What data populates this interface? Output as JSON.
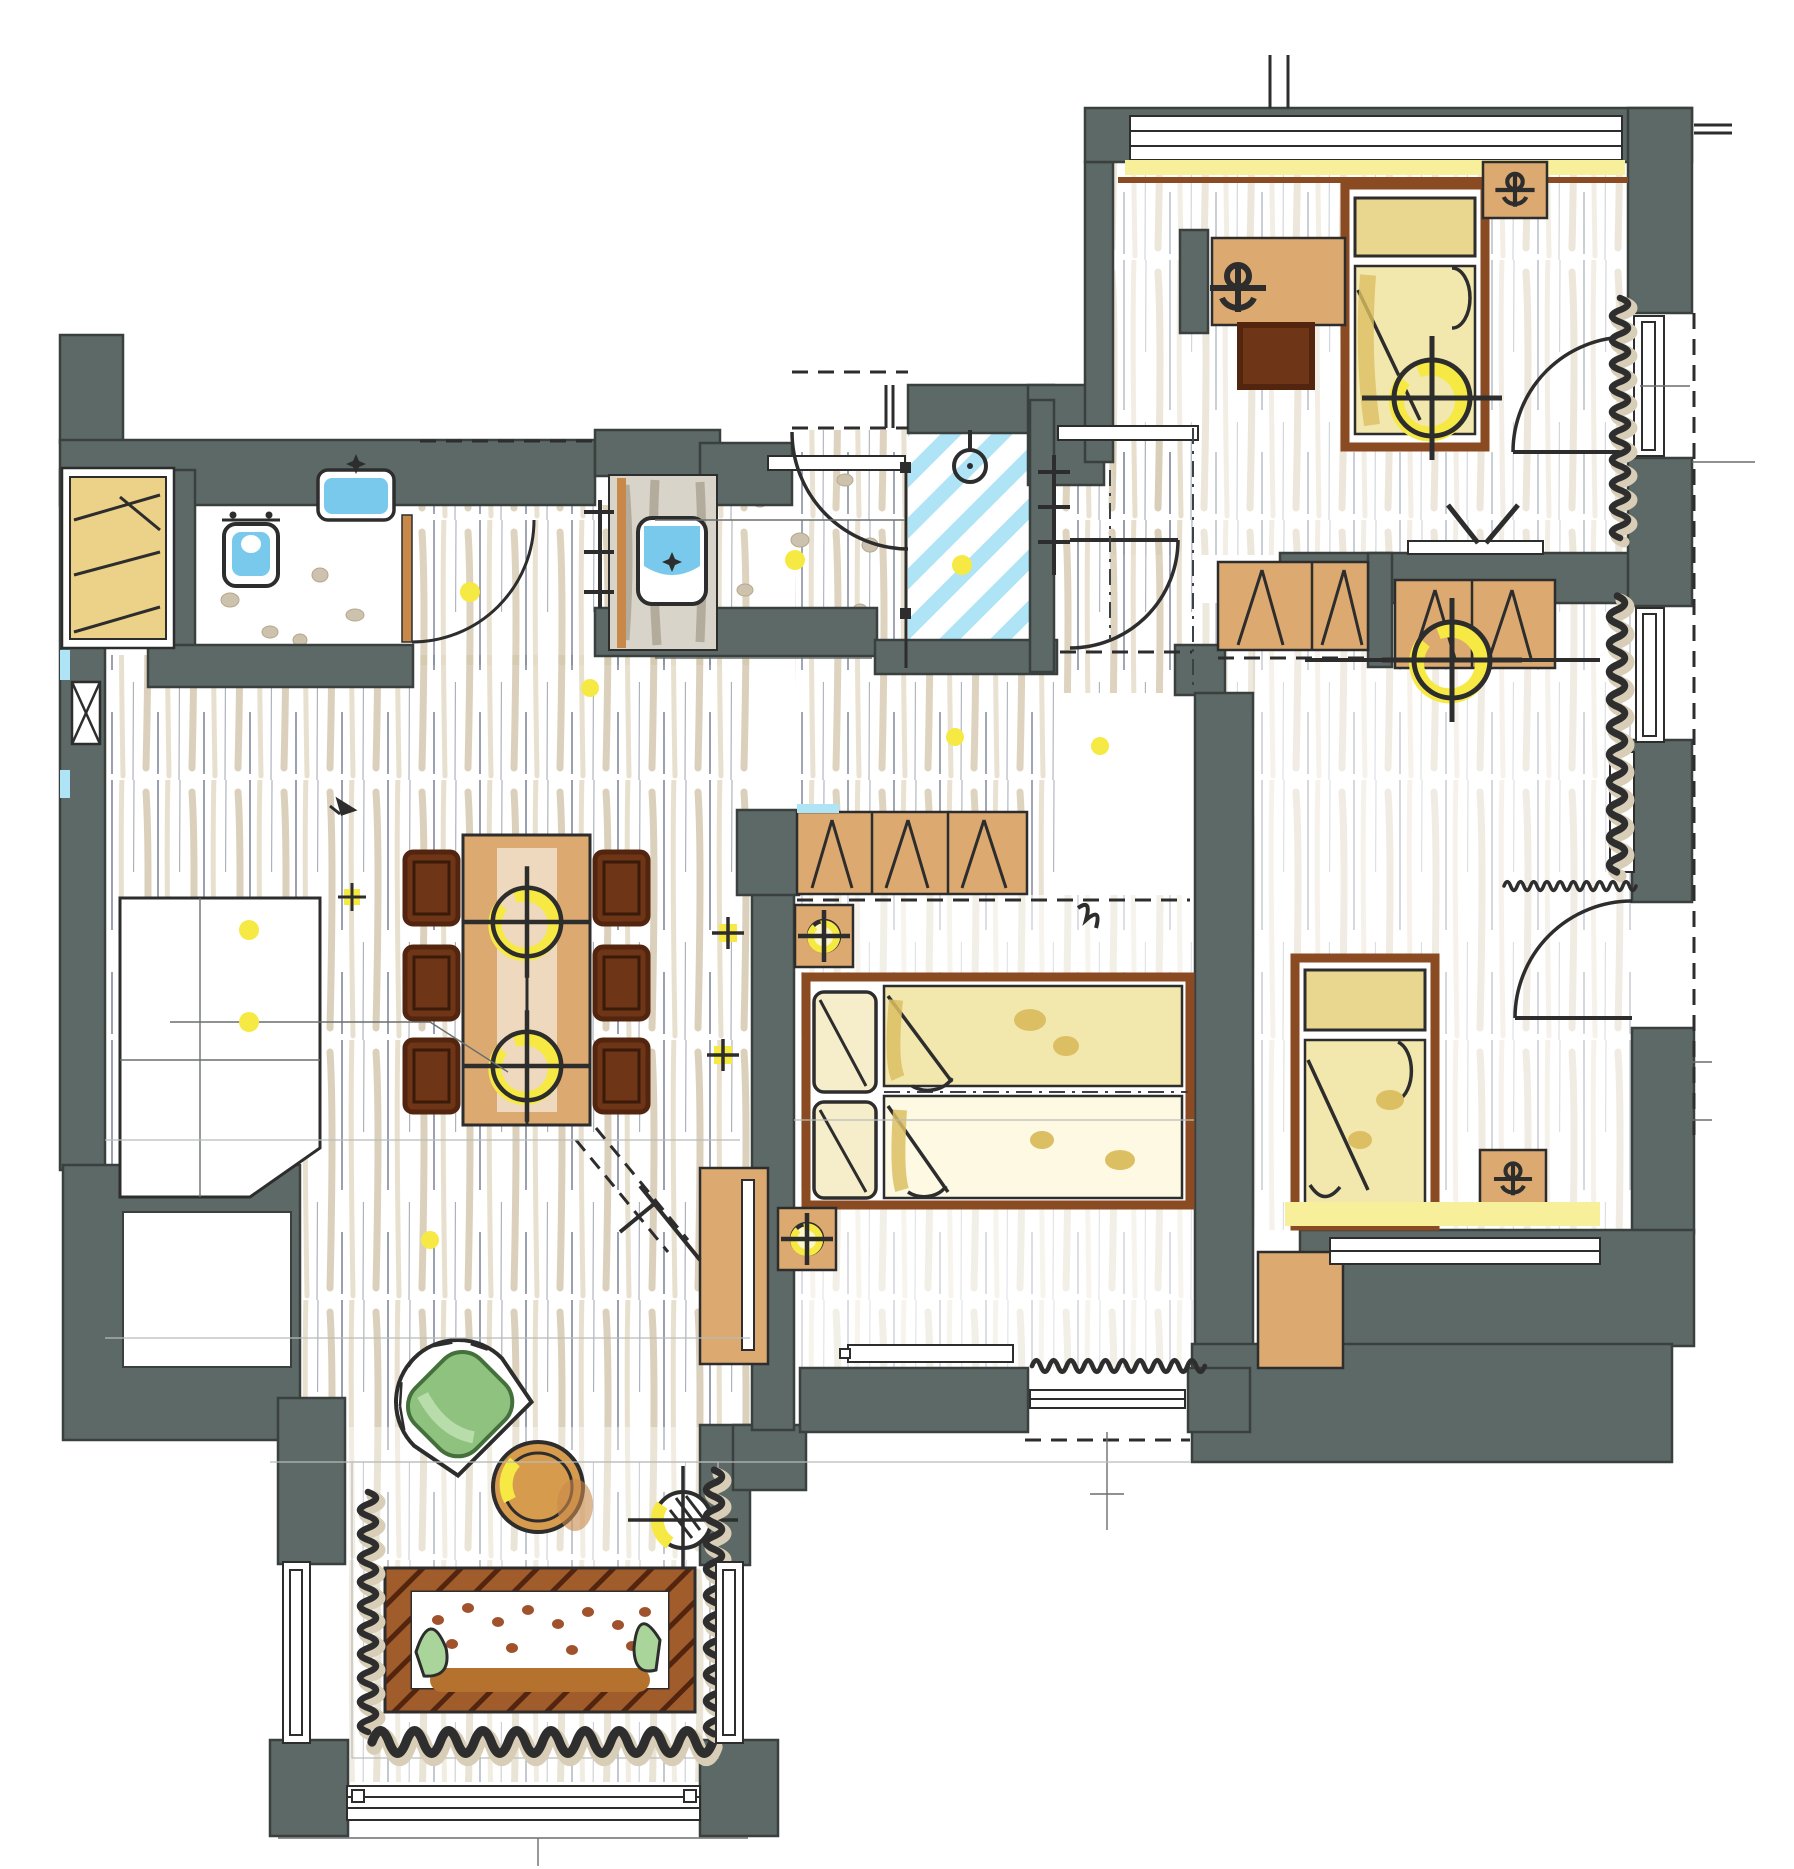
{
  "document": {
    "kind": "hand-drawn apartment floor plan, marker rendering, top-down view",
    "canvas_px": {
      "width": 1794,
      "height": 1869
    },
    "visible_text": []
  },
  "palette": {
    "wall": "#5d6966",
    "wallLine": "#39403e",
    "ink": "#2d2d2d",
    "woodStroke": "#d5c8af",
    "floorLine": "#4a5570",
    "tan": "#dcaa70",
    "tanDark": "#c8884a",
    "woodBrown": "#8a4a22",
    "chairBrown": "#6f3517",
    "chairBrownDark": "#53250e",
    "yellow": "#f6e944",
    "bedding": "#e9d78f",
    "beddingDeep": "#dcbf63",
    "blue": "#79c9ec",
    "blueLight": "#aee4f6",
    "green": "#8fc17f",
    "greenDark": "#44703c",
    "pebble": "#cdc2ad",
    "curtain": "#2e2e2e",
    "curtainShadow": "#d8cdb6",
    "sofaBrown": "#a15c2c",
    "sofaHatch": "#53250e",
    "dotBrown": "#a0522d"
  },
  "rooms": [
    {
      "id": "entry-hall",
      "features": [
        "entry-door-swing",
        "coat-rail",
        "overhead-closet-dashed"
      ]
    },
    {
      "id": "wc",
      "features": [
        "toilet",
        "hand-basin",
        "door-swing",
        "pebble-tile-floor"
      ]
    },
    {
      "id": "bathroom",
      "features": [
        "vanity-basin",
        "towel-radiator",
        "pebble-tile-floor",
        "ceiling-spot"
      ]
    },
    {
      "id": "shower",
      "features": [
        "shower-head",
        "glass-screen",
        "blue-striped-floor",
        "ceiling-spot"
      ]
    },
    {
      "id": "living-dining",
      "features": [
        "dining-table",
        "6-chairs",
        "2-pendant-lights",
        "kitchenette-counter",
        "tv-lowboard"
      ]
    },
    {
      "id": "bay-window-lounge",
      "features": [
        "sofa",
        "green-armchair",
        "round-side-table",
        "floor-lamp",
        "curtains",
        "3-windows"
      ]
    },
    {
      "id": "master-bedroom",
      "features": [
        "double-bed",
        "2-nightstand-lamps",
        "wardrobe-row",
        "radiator",
        "window",
        "curtain"
      ]
    },
    {
      "id": "bedroom-2",
      "features": [
        "single-bed",
        "desk",
        "desk-chair",
        "nightstand",
        "ceiling-light",
        "balcony-door",
        "window-radiator",
        "curtain"
      ]
    },
    {
      "id": "bedroom-3",
      "features": [
        "single-bed",
        "wardrobe",
        "tv-shelf",
        "nightstand",
        "dresser",
        "ceiling-light",
        "balcony-door",
        "window-radiator",
        "curtain"
      ]
    },
    {
      "id": "kids-hall",
      "features": [
        "door-swing",
        "wardrobe-row",
        "shelf"
      ]
    }
  ],
  "symbols": {
    "ceiling_light": "circle with cross axes and yellow ring",
    "spot_light": "small yellow dot",
    "table_lamp": "small circle with cross",
    "radiator": "narrow white rectangle inside window opening",
    "curtain": "dark squiggle line along window",
    "door": "quarter-circle swing arc",
    "wardrobe_mark": "diagonal opening lines on tan carcass",
    "balcony_line": "dashed outline outside east wall"
  },
  "counts": {
    "ceiling_lights": 4,
    "pendant_lights": 2,
    "table_lamps": 2,
    "spot_lights": 10,
    "doors": 6,
    "balcony_doors": 2,
    "windows": 8,
    "radiators": 6,
    "beds": 3,
    "chairs": 7,
    "sofas": 1,
    "wardrobe_runs": 5,
    "sinks": 3,
    "toilets": 1,
    "showers": 1
  }
}
